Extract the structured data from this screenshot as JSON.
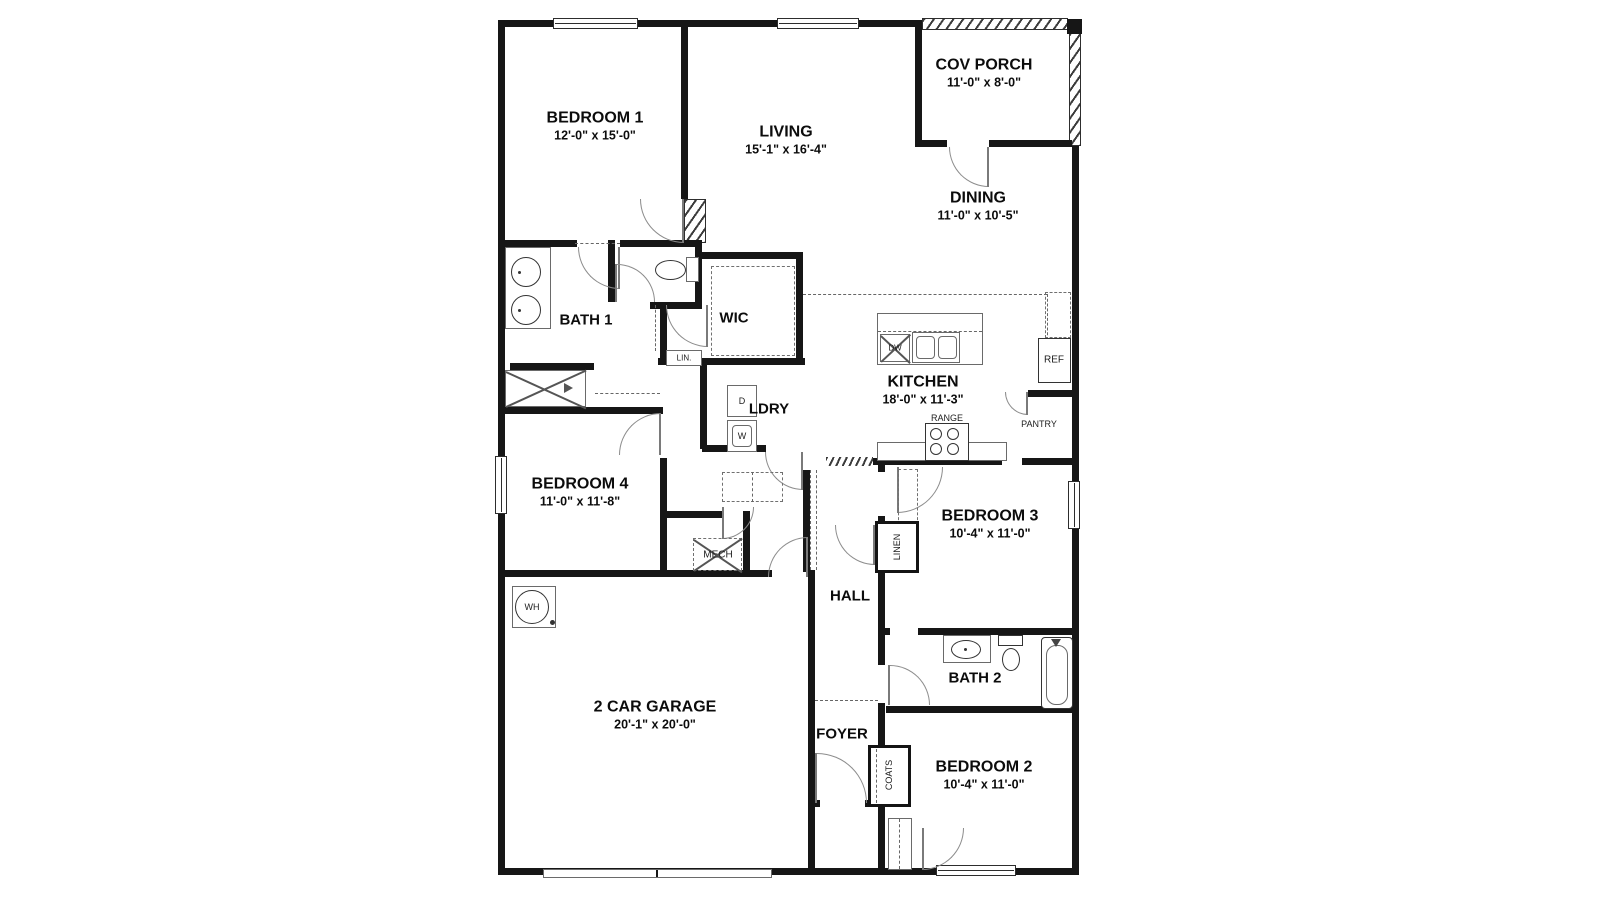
{
  "rooms": {
    "bedroom1": {
      "name": "BEDROOM 1",
      "dims": "12'-0\" x 15'-0\""
    },
    "living": {
      "name": "LIVING",
      "dims": "15'-1\" x 16'-4\""
    },
    "cov_porch": {
      "name": "COV PORCH",
      "dims": "11'-0\" x 8'-0\""
    },
    "dining": {
      "name": "DINING",
      "dims": "11'-0\" x 10'-5\""
    },
    "bath1": {
      "name": "BATH 1"
    },
    "wic": {
      "name": "WIC"
    },
    "kitchen": {
      "name": "KITCHEN",
      "dims": "18'-0\" x 11'-3\""
    },
    "ldry": {
      "name": "LDRY"
    },
    "bedroom4": {
      "name": "BEDROOM 4",
      "dims": "11'-0\" x 11'-8\""
    },
    "bedroom3": {
      "name": "BEDROOM 3",
      "dims": "10'-4\" x 11'-0\""
    },
    "hall": {
      "name": "HALL"
    },
    "bath2": {
      "name": "BATH 2"
    },
    "garage": {
      "name": "2 CAR GARAGE",
      "dims": "20'-1\" x 20'-0\""
    },
    "foyer": {
      "name": "FOYER"
    },
    "bedroom2": {
      "name": "BEDROOM 2",
      "dims": "10'-4\" x 11'-0\""
    }
  },
  "fixtures": {
    "lin": "LIN.",
    "linen": "LINEN",
    "coats": "COATS",
    "mech": "MECH",
    "wh": "WH",
    "dryer": "D",
    "washer": "W",
    "dw": "DW",
    "ref": "REF",
    "range": "RANGE",
    "pantry": "PANTRY"
  },
  "colors": {
    "wall": "#161616",
    "thin_line": "#555555",
    "background": "#ffffff"
  }
}
